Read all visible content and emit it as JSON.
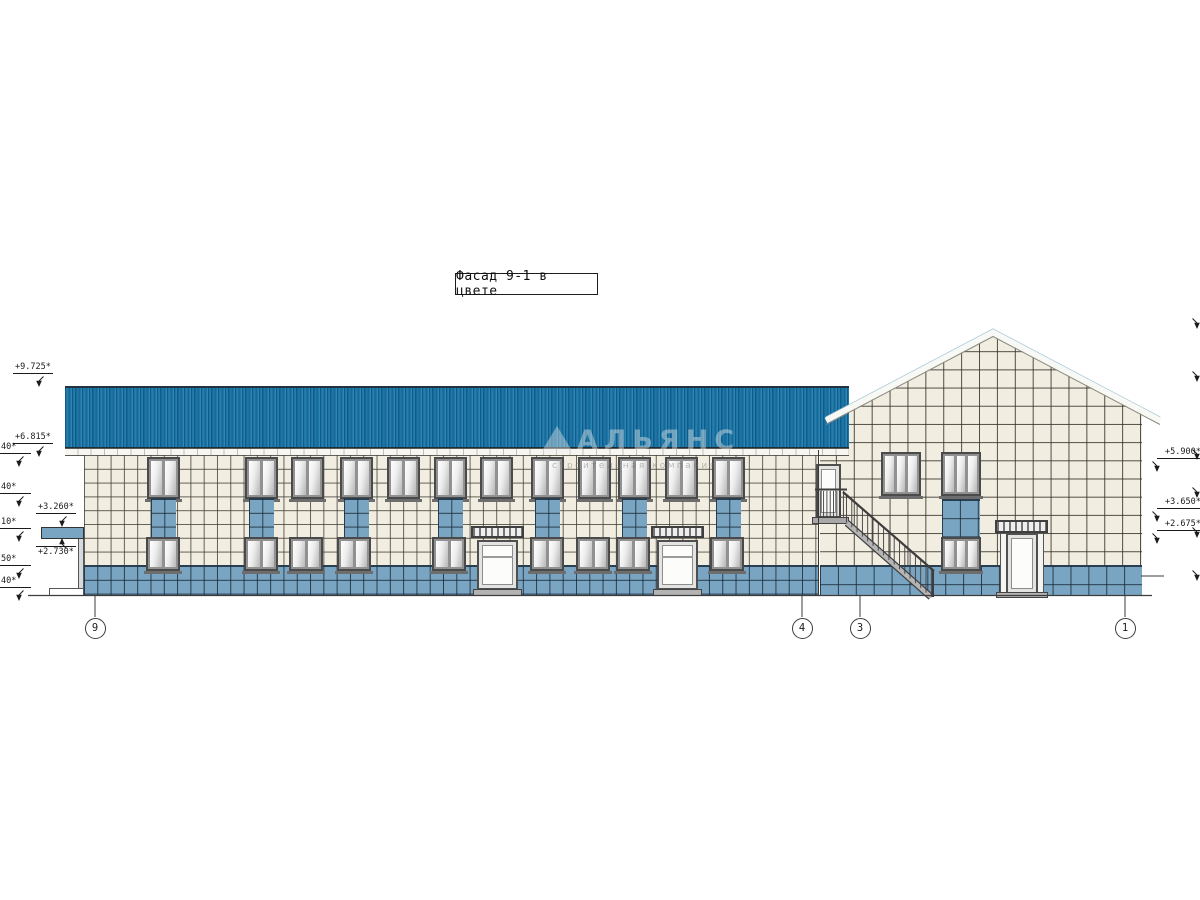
{
  "drawing": {
    "title": "Фасад 9-1 в цвете",
    "watermark": {
      "name": "АЛЬЯНС",
      "subtitle": "строительная компания"
    },
    "axis_bubbles": [
      "9",
      "4",
      "3",
      "1"
    ],
    "elevation_marks": {
      "left": [
        "+9.725*",
        "+6.815*",
        "+3.260*",
        "+2.730*"
      ],
      "left_clipped": [
        "40*",
        "40*",
        "10*",
        "50*",
        "40*"
      ],
      "right": [
        "+5.900*",
        "+3.650*",
        "+2.675*"
      ]
    },
    "colors": {
      "roof_blue": "#1e76a6",
      "tile_cream": "#f2ede1",
      "tile_blue": "#7aa5c2",
      "line_dark": "#3c3c34"
    }
  }
}
